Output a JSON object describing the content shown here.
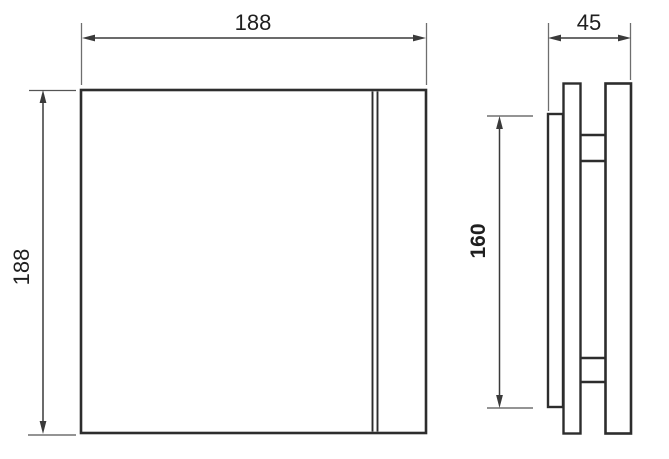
{
  "colors": {
    "background": "#ffffff",
    "object_line": "#2d2d2d",
    "dimension_line": "#3a3a3a",
    "extension_line": "#6e6e6e",
    "label_text": "#1f1f1f"
  },
  "front_view": {
    "width_label": "188",
    "height_label": "188"
  },
  "side_view": {
    "depth_label": "45",
    "backplate_height_label": "160"
  }
}
